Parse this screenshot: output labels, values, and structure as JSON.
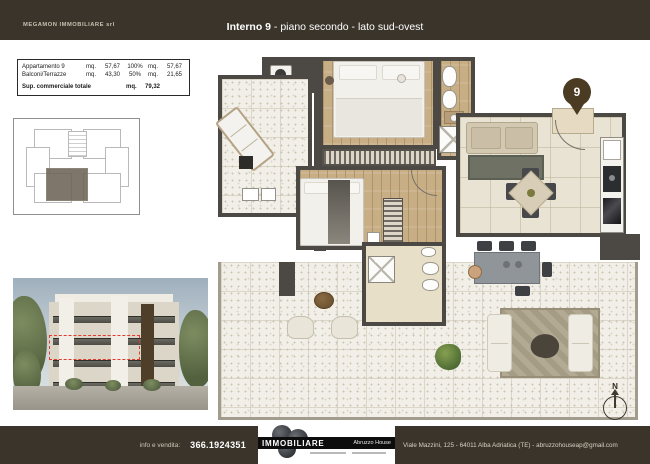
{
  "header": {
    "company": "MEGAMON IMMOBILIARE srl",
    "title_strong": "Interno 9",
    "title_rest": " - piano secondo - lato sud-ovest"
  },
  "summary": {
    "rows": [
      {
        "label": "Appartamento 9",
        "u1": "mq.",
        "v1": "57,67",
        "pct": "100%",
        "u2": "mq.",
        "v2": "57,67"
      },
      {
        "label": "Balconi/Terrazze",
        "u1": "mq.",
        "v1": "43,30",
        "pct": "50%",
        "u2": "mq.",
        "v2": "21,65"
      }
    ],
    "total_label": "Sup. commerciale totale",
    "total_unit": "mq.",
    "total_value": "79,32"
  },
  "plan": {
    "unit_pin": "9",
    "compass": "N"
  },
  "footer": {
    "info_label": "info e vendita:",
    "phone": "366.1924351",
    "brand": "IMMOBILIARE",
    "brand_secondary": "Abruzzo House",
    "address": "Viale Mazzini, 125 - 64011 Alba Adriatica (TE) - abruzzohouseap@gmail.com"
  },
  "colors": {
    "frame": "#3a342a",
    "wall": "#4c4944",
    "pin": "#4b3b23",
    "highlight_red": "#e23a2c"
  }
}
